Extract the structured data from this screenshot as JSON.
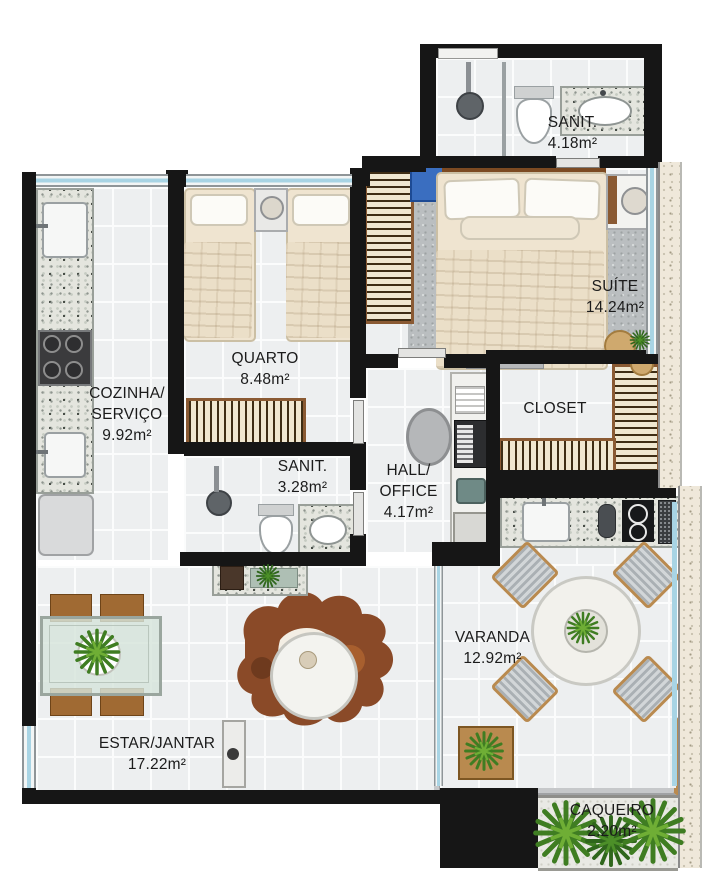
{
  "labels": {
    "sanit_suite": {
      "l1": "SANIT.",
      "area": "4.18m²"
    },
    "suite": {
      "l1": "SUÍTE",
      "area": "14.24m²"
    },
    "quarto": {
      "l1": "QUARTO",
      "area": "8.48m²"
    },
    "cozinha": {
      "l1": "COZINHA/",
      "l2": "SERVIÇO",
      "area": "9.92m²"
    },
    "closet": {
      "l1": "CLOSET"
    },
    "sanit_social": {
      "l1": "SANIT.",
      "area": "3.28m²"
    },
    "hall": {
      "l1": "HALL/",
      "l2": "OFFICE",
      "area": "4.17m²"
    },
    "varanda": {
      "l1": "VARANDA",
      "area": "12.92m²"
    },
    "estar": {
      "l1": "ESTAR/JANTAR",
      "area": "17.22m²"
    },
    "caqueiro": {
      "l1": "CAQUEIRO",
      "area": "2.20m²"
    }
  },
  "colors": {
    "wall": "#161616",
    "floor": "#edeff0",
    "tile_line": "#fbfcfc",
    "window_glass": "#a8d4e4",
    "granite": "#e4e5de",
    "wood": "#9a6432",
    "wardrobe_fill": "#f0e7d0",
    "sofa_gray": "#c6c8ca",
    "bed_linen": "#efe4d0",
    "suite_rug": "#babec0",
    "plant_green": "#3f7d22",
    "plant_light": "#6fae35",
    "exterior_wall": "#efe8da",
    "cowhide_brown": "#8a4a28"
  }
}
